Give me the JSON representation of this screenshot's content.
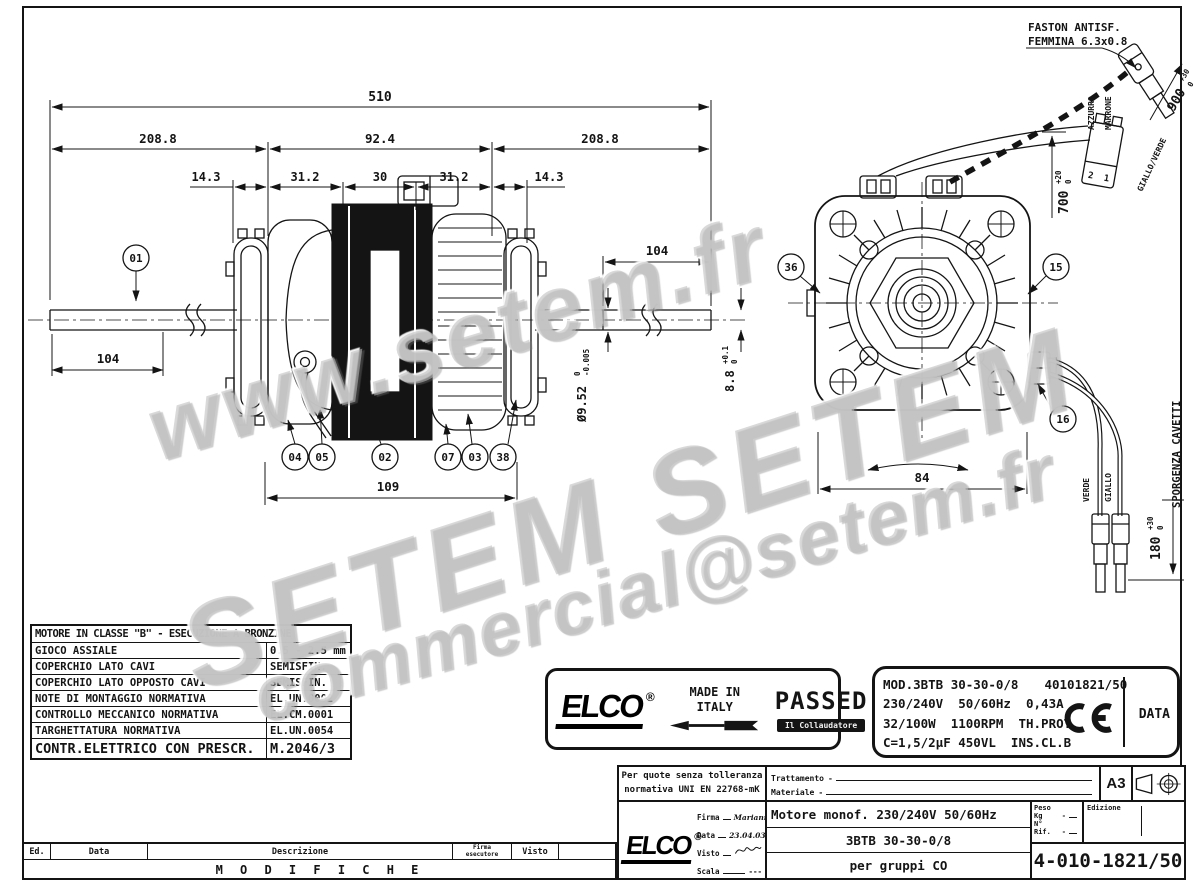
{
  "watermarks": {
    "w1": "www.setem.fr",
    "w2": "SETEM  SETEM",
    "w3": "commercial@setem.fr"
  },
  "drawing": {
    "faston_note_1": "FASTON ANTISF.",
    "faston_note_2": "FEMMINA 6.3x0.8",
    "dim_510": "510",
    "dim_208_left": "208.8",
    "dim_92": "92.4",
    "dim_208_right": "208.8",
    "dim_14_left": "14.3",
    "dim_31_left": "31.2",
    "dim_30": "30",
    "dim_31_right": "31.2",
    "dim_14_right": "14.3",
    "dim_104_left": "104",
    "dim_104_right": "104",
    "dim_109": "109",
    "dim_84": "84",
    "dia_value": "Ø9.52",
    "dia_tol_hi": "0",
    "dia_tol_lo": "-0.005",
    "flat_value": "8.8",
    "flat_tol_hi": "+0.1",
    "flat_tol_lo": "0",
    "wire_700": "700",
    "wire_700_hi": "+20",
    "wire_700_lo": "0",
    "wire_900": "900",
    "wire_900_hi": "+30",
    "wire_900_lo": "0",
    "cable_180": "180",
    "cable_180_hi": "+30",
    "cable_180_lo": "0",
    "cable_note": "SPORGENZA CAVETTI",
    "wire_azzurro": "AZZURRO",
    "wire_marrone": "MARRONE",
    "wire_giallo_verde": "GIALLO/VERDE",
    "wire_verde": "VERDE",
    "wire_giallo": "GIALLO",
    "pin_2": "2",
    "pin_1": "1",
    "balloon_01": "01",
    "balloon_02": "02",
    "balloon_03": "03",
    "balloon_04": "04",
    "balloon_05": "05",
    "balloon_07": "07",
    "balloon_15": "15",
    "balloon_16": "16",
    "balloon_36": "36",
    "balloon_38": "38"
  },
  "spec_table": {
    "header": "MOTORE IN CLASSE \"B\" - ESECUZIONE A BRONZINE",
    "rows": [
      {
        "label": "GIOCO ASSIALE",
        "value": "0.5 - 2.5 mm"
      },
      {
        "label": "COPERCHIO LATO CAVI",
        "value": "SEMISFIN."
      },
      {
        "label": "COPERCHIO LATO OPPOSTO CAVI",
        "value": "SEMISFIN."
      },
      {
        "label": "NOTE DI MONTAGGIO NORMATIVA",
        "value": "EL.UN.0002"
      },
      {
        "label": "CONTROLLO MECCANICO NORMATIVA",
        "value": "EL.CM.0001"
      },
      {
        "label": "TARGHETTATURA NORMATIVA",
        "value": "EL.UN.0054"
      },
      {
        "label": "CONTR.ELETTRICO CON PRESCR.",
        "value": "M.2046/3"
      }
    ]
  },
  "quality_label": {
    "brand": "ELCO",
    "registered": "®",
    "origin_1": "MADE IN",
    "origin_2": "ITALY",
    "stamp": "PASSED",
    "tester": "Il Collaudatore"
  },
  "nameplate": {
    "model": "MOD.3BTB 30-30-0/8",
    "serial": "40101821/50",
    "electrical": "230/240V  50/60Hz  0,43A",
    "power": "32/100W  1100RPM  TH.PROT",
    "capacitor": "C=1,5/2µF 450VL  INS.CL.B",
    "data_label": "DATA"
  },
  "title_block": {
    "tol_note_1": "Per quote senza tolleranza",
    "tol_note_2": "normativa UNI EN 22768-mK",
    "trattamento": "Trattamento",
    "trattamento_v": "-",
    "materiale": "Materiale",
    "materiale_v": "-",
    "format": "A3",
    "brand": "ELCO",
    "registered": "®",
    "firma": "Firma",
    "firma_v": "Mariani",
    "data": "Data",
    "data_v": "23.04.03",
    "visto": "Visto",
    "scala": "Scala",
    "scala_v": "---",
    "title_1": "Motore monof. 230/240V 50/60Hz",
    "title_2": "3BTB 30-30-0/8",
    "title_3": "per gruppi CO",
    "peso": "Peso Kg",
    "peso_v": "-",
    "rif": "N° Rif.",
    "rif_v": "-",
    "edizione": "Edizione",
    "number": "4-010-1821/50"
  },
  "revisions": {
    "ed": "Ed.",
    "data": "Data",
    "descrizione": "Descrizione",
    "firma_1": "Firma",
    "firma_2": "esecutore",
    "visto": "Visto",
    "modifiche": "M O D I F I C H E"
  }
}
